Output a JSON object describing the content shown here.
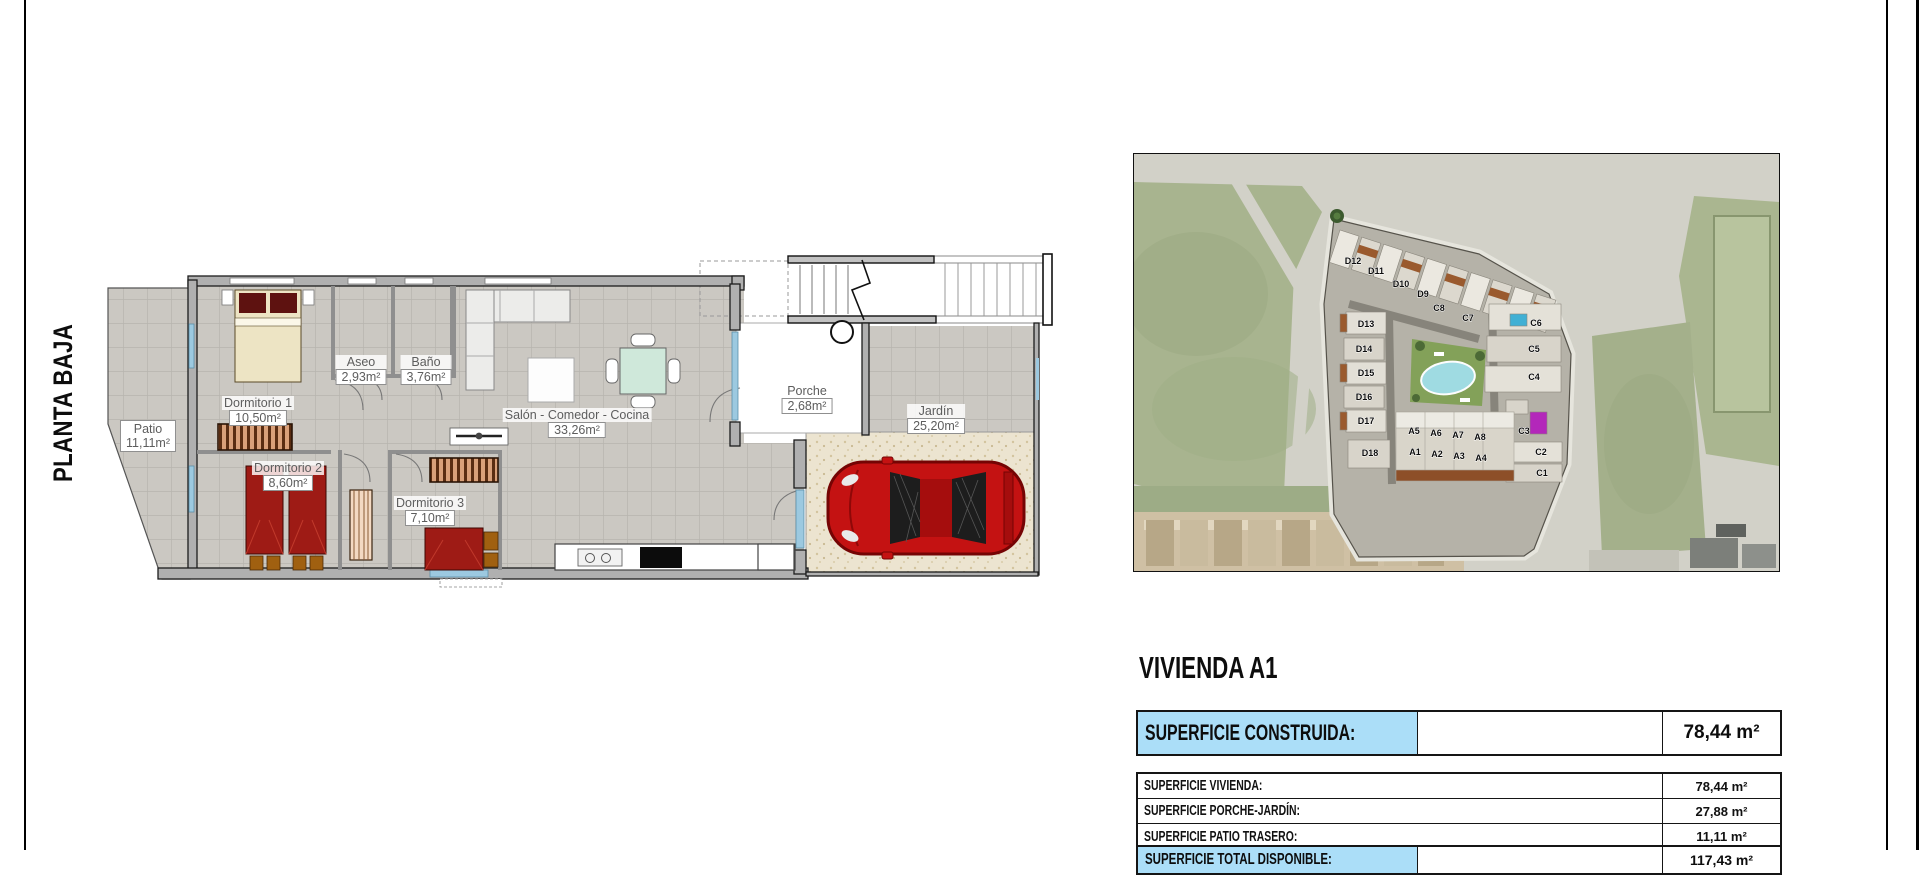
{
  "sheet": {
    "plan_label": "PLANTA BAJA"
  },
  "floor_plan": {
    "rooms": {
      "patio": {
        "name": "Patio",
        "area": "11,11m²"
      },
      "dorm1": {
        "name": "Dormitorio 1",
        "area": "10,50m²"
      },
      "aseo": {
        "name": "Aseo",
        "area": "2,93m²"
      },
      "bano": {
        "name": "Baño",
        "area": "3,76m²"
      },
      "salon": {
        "name": "Salón - Comedor - Cocina",
        "area": "33,26m²"
      },
      "dorm2": {
        "name": "Dormitorio 2",
        "area": "8,60m²"
      },
      "dorm3": {
        "name": "Dormitorio 3",
        "area": "7,10m²"
      },
      "porche": {
        "name": "Porche",
        "area": "2,68m²"
      },
      "jardin": {
        "name": "Jardín",
        "area": "25,20m²"
      }
    }
  },
  "site_plan": {
    "blocks": [
      "D12",
      "D11",
      "D10",
      "D9",
      "C8",
      "C7",
      "D13",
      "D14",
      "D15",
      "D16",
      "D17",
      "D18",
      "C6",
      "C5",
      "C4",
      "C3",
      "C2",
      "C1",
      "A5",
      "A6",
      "A7",
      "A8",
      "A1",
      "A2",
      "A3",
      "A4"
    ]
  },
  "summary": {
    "title": "VIVIENDA A1",
    "highlight_row": {
      "label": "SUPERFICIE CONSTRUIDA:",
      "value": "78,44 m²"
    },
    "rows": [
      {
        "label": "SUPERFICIE VIVIENDA:",
        "value": "78,44 m²"
      },
      {
        "label": "SUPERFICIE PORCHE-JARDÍN:",
        "value": "27,88 m²"
      },
      {
        "label": "SUPERFICIE PATIO TRASERO:",
        "value": "11,11 m²"
      }
    ],
    "total_row": {
      "label": "SUPERFICIE TOTAL DISPONIBLE:",
      "value": "117,43 m²"
    }
  },
  "colors": {
    "highlight_blue": "#abdef8",
    "wall_gray": "#b0b0b0",
    "tile_gray": "#cbc8c2",
    "bed_red": "#9e1b15",
    "car_red": "#c41212",
    "pool_blue": "#9fdbe2",
    "courtyard_green": "#83a159"
  }
}
